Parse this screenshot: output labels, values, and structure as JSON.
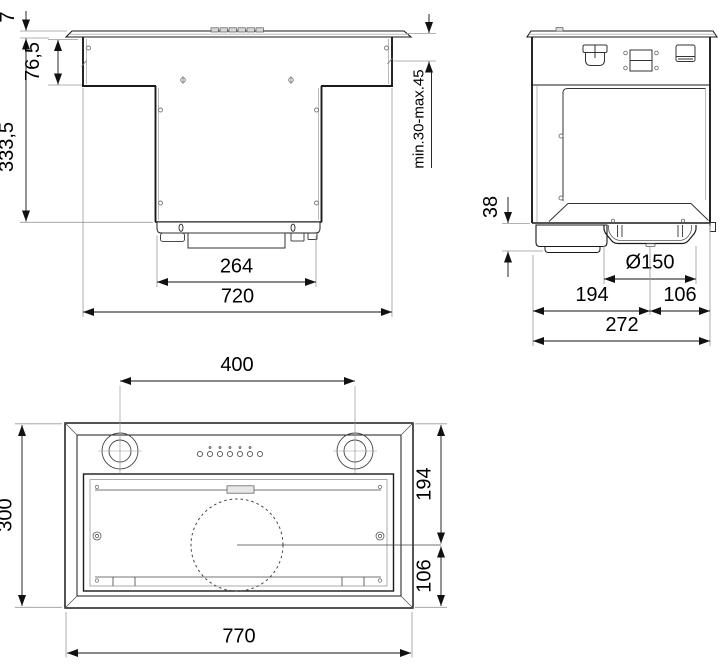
{
  "views": {
    "front": {
      "dims": {
        "frame_thickness": "7",
        "upper_body_height": "76,5",
        "total_height": "333,5",
        "mounting_range": "min.30-max.45",
        "filter_box_width": "264",
        "body_width": "720"
      }
    },
    "side": {
      "dims": {
        "lower_edge_height": "38",
        "outlet_diameter": "Ø150",
        "rear_to_outlet": "194",
        "outlet_to_front": "106",
        "total_depth": "272"
      }
    },
    "bottom": {
      "dims": {
        "lamp_spacing": "400",
        "side_depth": "300",
        "front_to_motor": "194",
        "motor_to_back": "106",
        "total_width": "770"
      }
    }
  }
}
